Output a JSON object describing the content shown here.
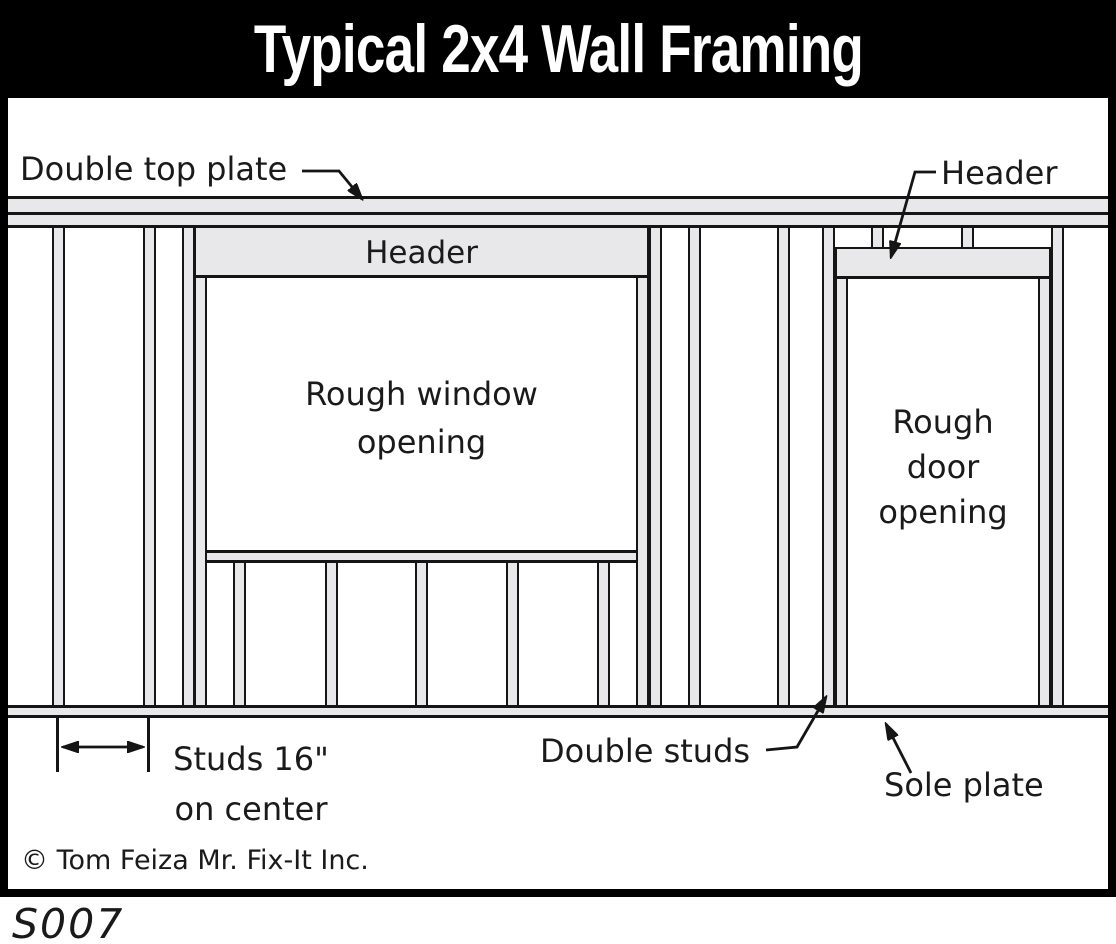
{
  "title": "Typical 2x4 Wall Framing",
  "colors": {
    "title_bg": "#000000",
    "title_fg": "#ffffff",
    "wood_fill": "#e8e8ea",
    "outline": "#151515",
    "background": "#ffffff"
  },
  "labels": {
    "double_top_plate": "Double top plate",
    "header_window": "Header",
    "header_door": "Header",
    "rough_window_line1": "Rough window",
    "rough_window_line2": "opening",
    "rough_door_line1": "Rough",
    "rough_door_line2": "door",
    "rough_door_line3": "opening",
    "studs_line1": "Studs 16\"",
    "studs_line2": "on center",
    "double_studs": "Double studs",
    "sole_plate": "Sole plate",
    "copyright": "© Tom Feiza Mr. Fix-It Inc.",
    "figure_code": "S007"
  }
}
